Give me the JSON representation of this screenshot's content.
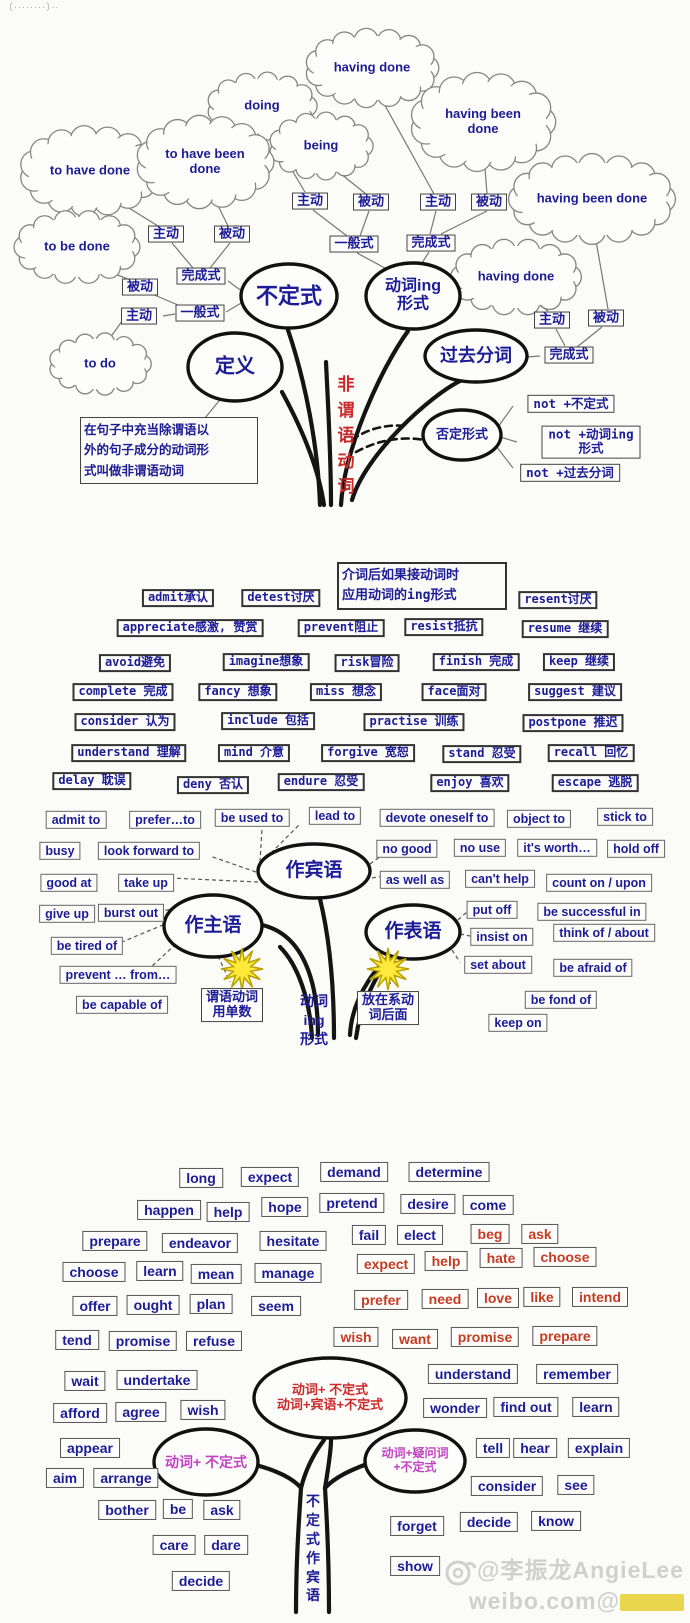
{
  "page": {
    "top_left_note": "〔········〕··",
    "watermark": {
      "line1": "@李振龙AngieLee",
      "line2": "weibo.com@"
    }
  },
  "colors": {
    "label_blue": "#1c1c96",
    "red3": "#c43c22",
    "magenta": "#c243c2",
    "trunk_red": "#cc2a2a",
    "star_yellow": "#ffe93a"
  },
  "section1": {
    "trunk_text": "非\n谓\n语\n动\n词",
    "definition": "在句子中充当除谓语以\n外的句子成分的动词形\n式叫做非谓语动词",
    "clouds": [
      {
        "t": "having done",
        "x": 372,
        "y": 68,
        "rx": 55,
        "ry": 28
      },
      {
        "t": "doing",
        "x": 262,
        "y": 106,
        "rx": 45,
        "ry": 24
      },
      {
        "t": "having been done",
        "x": 483,
        "y": 122,
        "rx": 58,
        "ry": 35
      },
      {
        "t": "being",
        "x": 321,
        "y": 146,
        "rx": 42,
        "ry": 24
      },
      {
        "t": "to have done",
        "x": 90,
        "y": 171,
        "rx": 57,
        "ry": 32
      },
      {
        "t": "to have been done",
        "x": 205,
        "y": 162,
        "rx": 55,
        "ry": 33
      },
      {
        "t": "having been done",
        "x": 592,
        "y": 199,
        "rx": 70,
        "ry": 32
      },
      {
        "t": "to be done",
        "x": 77,
        "y": 247,
        "rx": 52,
        "ry": 26
      },
      {
        "t": "having done",
        "x": 516,
        "y": 277,
        "rx": 54,
        "ry": 27
      },
      {
        "t": "to do",
        "x": 100,
        "y": 364,
        "rx": 42,
        "ry": 22
      }
    ],
    "ellipses": [
      {
        "t": "不定式",
        "x": 289,
        "y": 296,
        "rx": 48,
        "ry": 32,
        "fs": 22
      },
      {
        "t": "动词ing\n形式",
        "x": 413,
        "y": 296,
        "rx": 47,
        "ry": 33,
        "fs": 16
      },
      {
        "t": "过去分词",
        "x": 476,
        "y": 356,
        "rx": 51,
        "ry": 26,
        "fs": 18
      },
      {
        "t": "定义",
        "x": 235,
        "y": 367,
        "rx": 47,
        "ry": 34,
        "fs": 20
      },
      {
        "t": "否定形式",
        "x": 462,
        "y": 435,
        "rx": 39,
        "ry": 25,
        "fs": 13
      }
    ],
    "boxes": [
      {
        "t": "主动",
        "x": 310,
        "y": 201
      },
      {
        "t": "被动",
        "x": 371,
        "y": 202
      },
      {
        "t": "主动",
        "x": 438,
        "y": 202
      },
      {
        "t": "被动",
        "x": 489,
        "y": 202
      },
      {
        "t": "一般式",
        "x": 354,
        "y": 244
      },
      {
        "t": "完成式",
        "x": 431,
        "y": 243
      },
      {
        "t": "主动",
        "x": 166,
        "y": 234
      },
      {
        "t": "被动",
        "x": 232,
        "y": 234
      },
      {
        "t": "完成式",
        "x": 201,
        "y": 276
      },
      {
        "t": "被动",
        "x": 140,
        "y": 287
      },
      {
        "t": "主动",
        "x": 139,
        "y": 316
      },
      {
        "t": "一般式",
        "x": 200,
        "y": 313
      },
      {
        "t": "主动",
        "x": 552,
        "y": 320
      },
      {
        "t": "被动",
        "x": 606,
        "y": 318
      },
      {
        "t": "完成式",
        "x": 569,
        "y": 355
      }
    ],
    "not_boxes": [
      {
        "t": "not +不定式",
        "x": 571,
        "y": 404
      },
      {
        "t": "not +动词ing形式",
        "x": 591,
        "y": 442
      },
      {
        "t": "not +过去分词",
        "x": 570,
        "y": 473
      }
    ]
  },
  "section2": {
    "trunk_text": "动词\ning\n形式",
    "note": "介词后如果接动词时\n应用动词的ing形式",
    "verb_boxes": [
      {
        "t": "admit承认",
        "x": 178,
        "y": 598
      },
      {
        "t": "detest讨厌",
        "x": 281,
        "y": 598
      },
      {
        "t": "resent讨厌",
        "x": 558,
        "y": 600
      },
      {
        "t": "appreciate感激, 赞赏",
        "x": 190,
        "y": 628
      },
      {
        "t": "prevent阻止",
        "x": 341,
        "y": 628
      },
      {
        "t": "resist抵抗",
        "x": 444,
        "y": 627
      },
      {
        "t": "resume 继续",
        "x": 565,
        "y": 629
      },
      {
        "t": "avoid避免",
        "x": 135,
        "y": 663
      },
      {
        "t": "imagine想象",
        "x": 266,
        "y": 662
      },
      {
        "t": "risk冒险",
        "x": 367,
        "y": 663
      },
      {
        "t": "finish 完成",
        "x": 476,
        "y": 662
      },
      {
        "t": "keep 继续",
        "x": 579,
        "y": 662
      },
      {
        "t": "complete 完成",
        "x": 123,
        "y": 692
      },
      {
        "t": "fancy 想象",
        "x": 238,
        "y": 692
      },
      {
        "t": "miss 想念",
        "x": 346,
        "y": 692
      },
      {
        "t": "face面对",
        "x": 454,
        "y": 692
      },
      {
        "t": "suggest 建议",
        "x": 575,
        "y": 692
      },
      {
        "t": "consider 认为",
        "x": 125,
        "y": 722
      },
      {
        "t": "include 包括",
        "x": 268,
        "y": 721
      },
      {
        "t": "practise 训练",
        "x": 414,
        "y": 722
      },
      {
        "t": "postpone 推迟",
        "x": 573,
        "y": 723
      },
      {
        "t": "understand 理解",
        "x": 129,
        "y": 753
      },
      {
        "t": "mind 介意",
        "x": 254,
        "y": 753
      },
      {
        "t": "forgive 宽恕",
        "x": 368,
        "y": 753
      },
      {
        "t": "stand 忍受",
        "x": 482,
        "y": 754
      },
      {
        "t": "recall 回忆",
        "x": 591,
        "y": 753
      },
      {
        "t": "delay 耽误",
        "x": 92,
        "y": 781
      },
      {
        "t": "deny 否认",
        "x": 213,
        "y": 785
      },
      {
        "t": "endure 忍受",
        "x": 321,
        "y": 782
      },
      {
        "t": "enjoy 喜欢",
        "x": 470,
        "y": 783
      },
      {
        "t": "escape 逃脱",
        "x": 595,
        "y": 783
      }
    ],
    "phrase_boxes": [
      {
        "t": "admit to",
        "x": 76,
        "y": 820
      },
      {
        "t": "prefer…to",
        "x": 165,
        "y": 820
      },
      {
        "t": "be used to",
        "x": 252,
        "y": 818
      },
      {
        "t": "lead to",
        "x": 335,
        "y": 816
      },
      {
        "t": "devote oneself to",
        "x": 437,
        "y": 818
      },
      {
        "t": "object to",
        "x": 539,
        "y": 819
      },
      {
        "t": "stick to",
        "x": 625,
        "y": 817
      },
      {
        "t": "busy",
        "x": 60,
        "y": 851
      },
      {
        "t": "look forward to",
        "x": 149,
        "y": 851
      },
      {
        "t": "no good",
        "x": 407,
        "y": 849
      },
      {
        "t": "no use",
        "x": 480,
        "y": 848
      },
      {
        "t": "it's worth…",
        "x": 557,
        "y": 848
      },
      {
        "t": "hold off",
        "x": 636,
        "y": 849
      },
      {
        "t": "good at",
        "x": 69,
        "y": 883
      },
      {
        "t": "take up",
        "x": 146,
        "y": 883
      },
      {
        "t": "as well as",
        "x": 415,
        "y": 880
      },
      {
        "t": "can't help",
        "x": 500,
        "y": 879
      },
      {
        "t": "count on / upon",
        "x": 599,
        "y": 883
      },
      {
        "t": "give up",
        "x": 67,
        "y": 914
      },
      {
        "t": "burst out",
        "x": 131,
        "y": 913
      },
      {
        "t": "put off",
        "x": 492,
        "y": 910
      },
      {
        "t": "be successful in",
        "x": 592,
        "y": 912
      },
      {
        "t": "be tired of",
        "x": 87,
        "y": 946
      },
      {
        "t": "insist on",
        "x": 502,
        "y": 937
      },
      {
        "t": "think of / about",
        "x": 604,
        "y": 933
      },
      {
        "t": "prevent … from…",
        "x": 118,
        "y": 975
      },
      {
        "t": "set about",
        "x": 498,
        "y": 965
      },
      {
        "t": "be afraid of",
        "x": 593,
        "y": 968
      },
      {
        "t": "be capable of",
        "x": 122,
        "y": 1005
      },
      {
        "t": "be fond of",
        "x": 561,
        "y": 1000
      },
      {
        "t": "keep on",
        "x": 518,
        "y": 1023
      }
    ],
    "ellipses": [
      {
        "t": "作宾语",
        "x": 314,
        "y": 871,
        "rx": 56,
        "ry": 27,
        "fs": 19
      },
      {
        "t": "作主语",
        "x": 213,
        "y": 926,
        "rx": 49,
        "ry": 31,
        "fs": 19
      },
      {
        "t": "作表语",
        "x": 413,
        "y": 932,
        "rx": 47,
        "ry": 27,
        "fs": 19
      }
    ],
    "trunk_boxes": [
      {
        "t": "谓语动词\n用单数",
        "x": 232,
        "y": 1005
      },
      {
        "t": "放在系动\n词后面",
        "x": 388,
        "y": 1008
      }
    ]
  },
  "section3": {
    "trunk_text": "不\n定\n式\n作\n宾\n语",
    "blue_boxes": [
      {
        "t": "long",
        "x": 201,
        "y": 1178
      },
      {
        "t": "expect",
        "x": 270,
        "y": 1177
      },
      {
        "t": "demand",
        "x": 354,
        "y": 1172
      },
      {
        "t": "determine",
        "x": 449,
        "y": 1172
      },
      {
        "t": "happen",
        "x": 169,
        "y": 1210
      },
      {
        "t": "help",
        "x": 228,
        "y": 1212
      },
      {
        "t": "hope",
        "x": 285,
        "y": 1207
      },
      {
        "t": "pretend",
        "x": 352,
        "y": 1203
      },
      {
        "t": "desire",
        "x": 428,
        "y": 1204
      },
      {
        "t": "come",
        "x": 488,
        "y": 1205
      },
      {
        "t": "prepare",
        "x": 115,
        "y": 1241
      },
      {
        "t": "endeavor",
        "x": 200,
        "y": 1243
      },
      {
        "t": "hesitate",
        "x": 293,
        "y": 1241
      },
      {
        "t": "fail",
        "x": 369,
        "y": 1235
      },
      {
        "t": "elect",
        "x": 420,
        "y": 1235
      },
      {
        "t": "choose",
        "x": 94,
        "y": 1272
      },
      {
        "t": "learn",
        "x": 160,
        "y": 1271
      },
      {
        "t": "mean",
        "x": 216,
        "y": 1274
      },
      {
        "t": "manage",
        "x": 288,
        "y": 1273
      },
      {
        "t": "offer",
        "x": 95,
        "y": 1306
      },
      {
        "t": "ought",
        "x": 153,
        "y": 1305
      },
      {
        "t": "plan",
        "x": 211,
        "y": 1304
      },
      {
        "t": "seem",
        "x": 276,
        "y": 1306
      },
      {
        "t": "tend",
        "x": 77,
        "y": 1340
      },
      {
        "t": "promise",
        "x": 143,
        "y": 1341
      },
      {
        "t": "refuse",
        "x": 214,
        "y": 1341
      },
      {
        "t": "wait",
        "x": 85,
        "y": 1381
      },
      {
        "t": "undertake",
        "x": 157,
        "y": 1380
      },
      {
        "t": "afford",
        "x": 80,
        "y": 1413
      },
      {
        "t": "agree",
        "x": 141,
        "y": 1412
      },
      {
        "t": "wish",
        "x": 203,
        "y": 1410
      },
      {
        "t": "appear",
        "x": 90,
        "y": 1448
      },
      {
        "t": "aim",
        "x": 65,
        "y": 1478
      },
      {
        "t": "arrange",
        "x": 126,
        "y": 1478
      },
      {
        "t": "bother",
        "x": 127,
        "y": 1510
      },
      {
        "t": "be",
        "x": 178,
        "y": 1509
      },
      {
        "t": "ask",
        "x": 222,
        "y": 1510
      },
      {
        "t": "care",
        "x": 174,
        "y": 1545
      },
      {
        "t": "dare",
        "x": 226,
        "y": 1545
      },
      {
        "t": "decide",
        "x": 201,
        "y": 1581
      },
      {
        "t": "understand",
        "x": 473,
        "y": 1374
      },
      {
        "t": "remember",
        "x": 577,
        "y": 1374
      },
      {
        "t": "wonder",
        "x": 455,
        "y": 1408
      },
      {
        "t": "find out",
        "x": 526,
        "y": 1407
      },
      {
        "t": "learn",
        "x": 596,
        "y": 1407
      },
      {
        "t": "tell",
        "x": 493,
        "y": 1448
      },
      {
        "t": "hear",
        "x": 535,
        "y": 1448
      },
      {
        "t": "explain",
        "x": 599,
        "y": 1448
      },
      {
        "t": "consider",
        "x": 507,
        "y": 1486
      },
      {
        "t": "see",
        "x": 576,
        "y": 1485
      },
      {
        "t": "forget",
        "x": 417,
        "y": 1526
      },
      {
        "t": "decide",
        "x": 489,
        "y": 1522
      },
      {
        "t": "know",
        "x": 556,
        "y": 1521
      },
      {
        "t": "show",
        "x": 415,
        "y": 1566
      }
    ],
    "red_boxes": [
      {
        "t": "beg",
        "x": 490,
        "y": 1234
      },
      {
        "t": "ask",
        "x": 540,
        "y": 1234
      },
      {
        "t": "expect",
        "x": 386,
        "y": 1264
      },
      {
        "t": "help",
        "x": 446,
        "y": 1261
      },
      {
        "t": "hate",
        "x": 501,
        "y": 1258
      },
      {
        "t": "choose",
        "x": 565,
        "y": 1257
      },
      {
        "t": "prefer",
        "x": 381,
        "y": 1300
      },
      {
        "t": "need",
        "x": 445,
        "y": 1299
      },
      {
        "t": "love",
        "x": 498,
        "y": 1298
      },
      {
        "t": "like",
        "x": 542,
        "y": 1297
      },
      {
        "t": "intend",
        "x": 600,
        "y": 1297
      },
      {
        "t": "wish",
        "x": 356,
        "y": 1337
      },
      {
        "t": "want",
        "x": 415,
        "y": 1339
      },
      {
        "t": "promise",
        "x": 485,
        "y": 1337
      },
      {
        "t": "prepare",
        "x": 565,
        "y": 1336
      }
    ],
    "ellipses": [
      {
        "t": "动词+ 不定式\n动词+宾语+不定式",
        "x": 330,
        "y": 1398,
        "rx": 76,
        "ry": 40,
        "fs": 13,
        "color": "#cc2a2a"
      },
      {
        "t": "动词+ 不定式",
        "x": 206,
        "y": 1462,
        "rx": 52,
        "ry": 33,
        "fs": 14,
        "color": "#c243c2"
      },
      {
        "t": "动词+疑问词\n+不定式",
        "x": 415,
        "y": 1461,
        "rx": 50,
        "ry": 31,
        "fs": 12,
        "color": "#c243c2"
      }
    ]
  }
}
